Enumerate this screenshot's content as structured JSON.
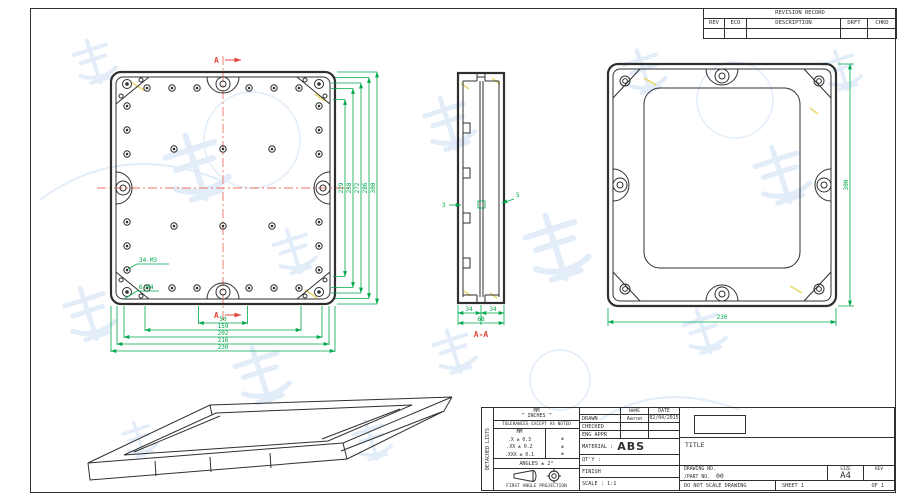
{
  "palette": {
    "line": "#2f2f2f",
    "dim_green": "#00a84c",
    "marker_red": "#e0463c",
    "centerline_red": "#ef7166",
    "watermark_blue": "#d8e7f7",
    "highlight_yellow": "#e9d867"
  },
  "revision_table": {
    "title": "REVISION RECORD",
    "columns": [
      "REV",
      "ECO",
      "DESCRIPTION",
      "DRFT",
      "CHKD"
    ]
  },
  "top_view": {
    "section_marker_top": "A",
    "section_marker_bottom": "A",
    "label_m3": "34-M3",
    "label_m4": "6-M4",
    "bottom_dims": [
      "50",
      "159",
      "202",
      "216",
      "230"
    ],
    "right_dims": [
      "229",
      "258",
      "272",
      "286",
      "300"
    ]
  },
  "section_view": {
    "dim_wall_left": "3",
    "dim_wall_right": "5",
    "dim_half_left": "34",
    "dim_half_right": "34",
    "dim_total": "68",
    "label": "A-A"
  },
  "back_view": {
    "dim_width": "230",
    "dim_height": "300"
  },
  "title_block": {
    "side_label": "DETACHED LISTS",
    "units_mm": "MM",
    "units_inches": "INCHES",
    "arrow_left": "←",
    "arrow_right": "→",
    "tolerance_note": "TOLERANCES EXCEPT AS NOTED",
    "tol_col_header": "MM",
    "tol_rows": [
      ".X ± 0.3",
      ".XX ± 0.2",
      ".XXX ± 0.1"
    ],
    "tol_marks": [
      "±",
      "±",
      "±"
    ],
    "angles": "ANGLES ± 2°",
    "projection": "FIRST ANGLE PROJECTION",
    "name_header": "NAME",
    "date_header": "DATE",
    "drawn_label": "DRAWN",
    "drawn_name": "Aaron",
    "drawn_date": "02/04/2015",
    "checked_label": "CHECKED",
    "eng_appr_label": "ENG APPR",
    "material_label": "MATERIAL :",
    "material_value": "ABS",
    "qty_label": "QT'Y :",
    "finish_label": "FINISH",
    "scale_label": "SCALE : 1:1",
    "title_label": "TITLE",
    "drawing_no_label": "DRAWING NO.",
    "part_no_label": "/PART NO.",
    "part_no_value": "00",
    "size_label": "SIZE",
    "size_value": "A4",
    "rev_label": "REV",
    "do_not_scale": "DO NOT SCALE DRAWING",
    "sheet_label": "SHEET 1",
    "of_label": "OF 1"
  }
}
